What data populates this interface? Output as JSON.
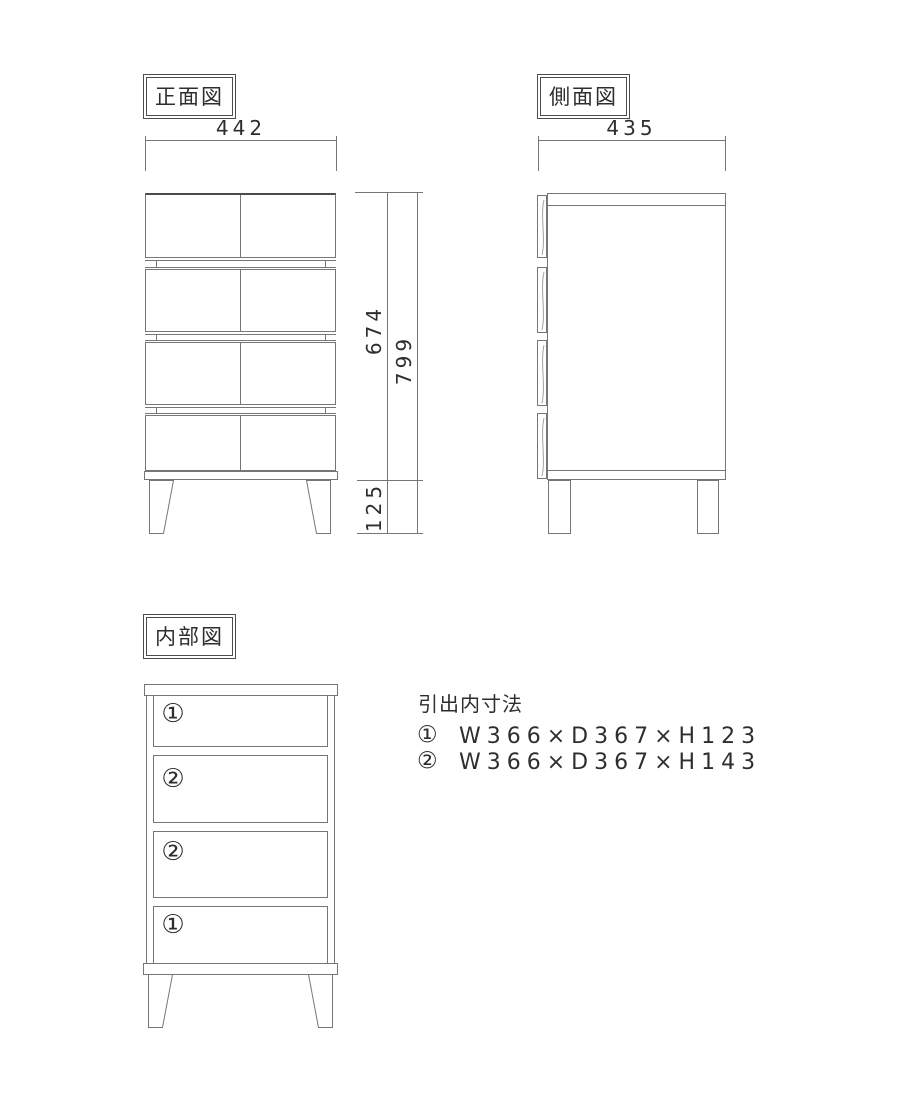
{
  "colors": {
    "line": "#767676",
    "text": "#2e2e2e"
  },
  "front_view": {
    "title": "正面図",
    "width_dim": "442",
    "body_height_dim": "674",
    "leg_height_dim": "125",
    "total_height_dim": "799"
  },
  "side_view": {
    "title": "側面図",
    "depth_dim": "435"
  },
  "internal_view": {
    "title": "内部図",
    "compartments": [
      "①",
      "②",
      "②",
      "①"
    ]
  },
  "drawer_dimensions": {
    "heading": "引出内寸法",
    "items": [
      {
        "mark": "①",
        "text": "W366×D367×H123"
      },
      {
        "mark": "②",
        "text": "W366×D367×H143"
      }
    ]
  }
}
